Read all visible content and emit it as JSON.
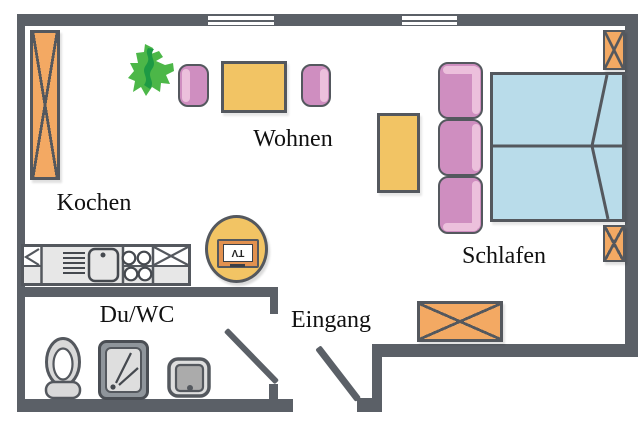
{
  "rooms": {
    "wohnen": {
      "label": "Wohnen"
    },
    "kochen": {
      "label": "Kochen"
    },
    "schlafen": {
      "label": "Schlafen"
    },
    "du_wc": {
      "label": "Du/WC"
    },
    "eingang": {
      "label": "Eingang"
    }
  },
  "tv": {
    "label": "TV"
  },
  "colors": {
    "wall": "#5b6067",
    "outline": "#54585e",
    "orange": "#f3a963",
    "yellow": "#f2c464",
    "pink": "#cf8ec0",
    "pink-light": "#ecc0dc",
    "blue": "#b9dcea",
    "green-light": "#4cb748",
    "green-dark": "#1d9a44",
    "gray": "#dedede",
    "floor": "#ffffff"
  },
  "icons": [
    "plant-icon",
    "tv-icon",
    "armchair-icon",
    "coffee-table-icon",
    "side-table-icon",
    "sofa-icon",
    "double-bed-icon",
    "nightstand-icon",
    "tall-cabinet-icon",
    "chest-icon",
    "kitchen-counter-icon",
    "kitchen-sink-icon",
    "stove-burners-icon",
    "toilet-icon",
    "shower-icon",
    "washbasin-icon",
    "window-icon",
    "door-swing-icon"
  ]
}
